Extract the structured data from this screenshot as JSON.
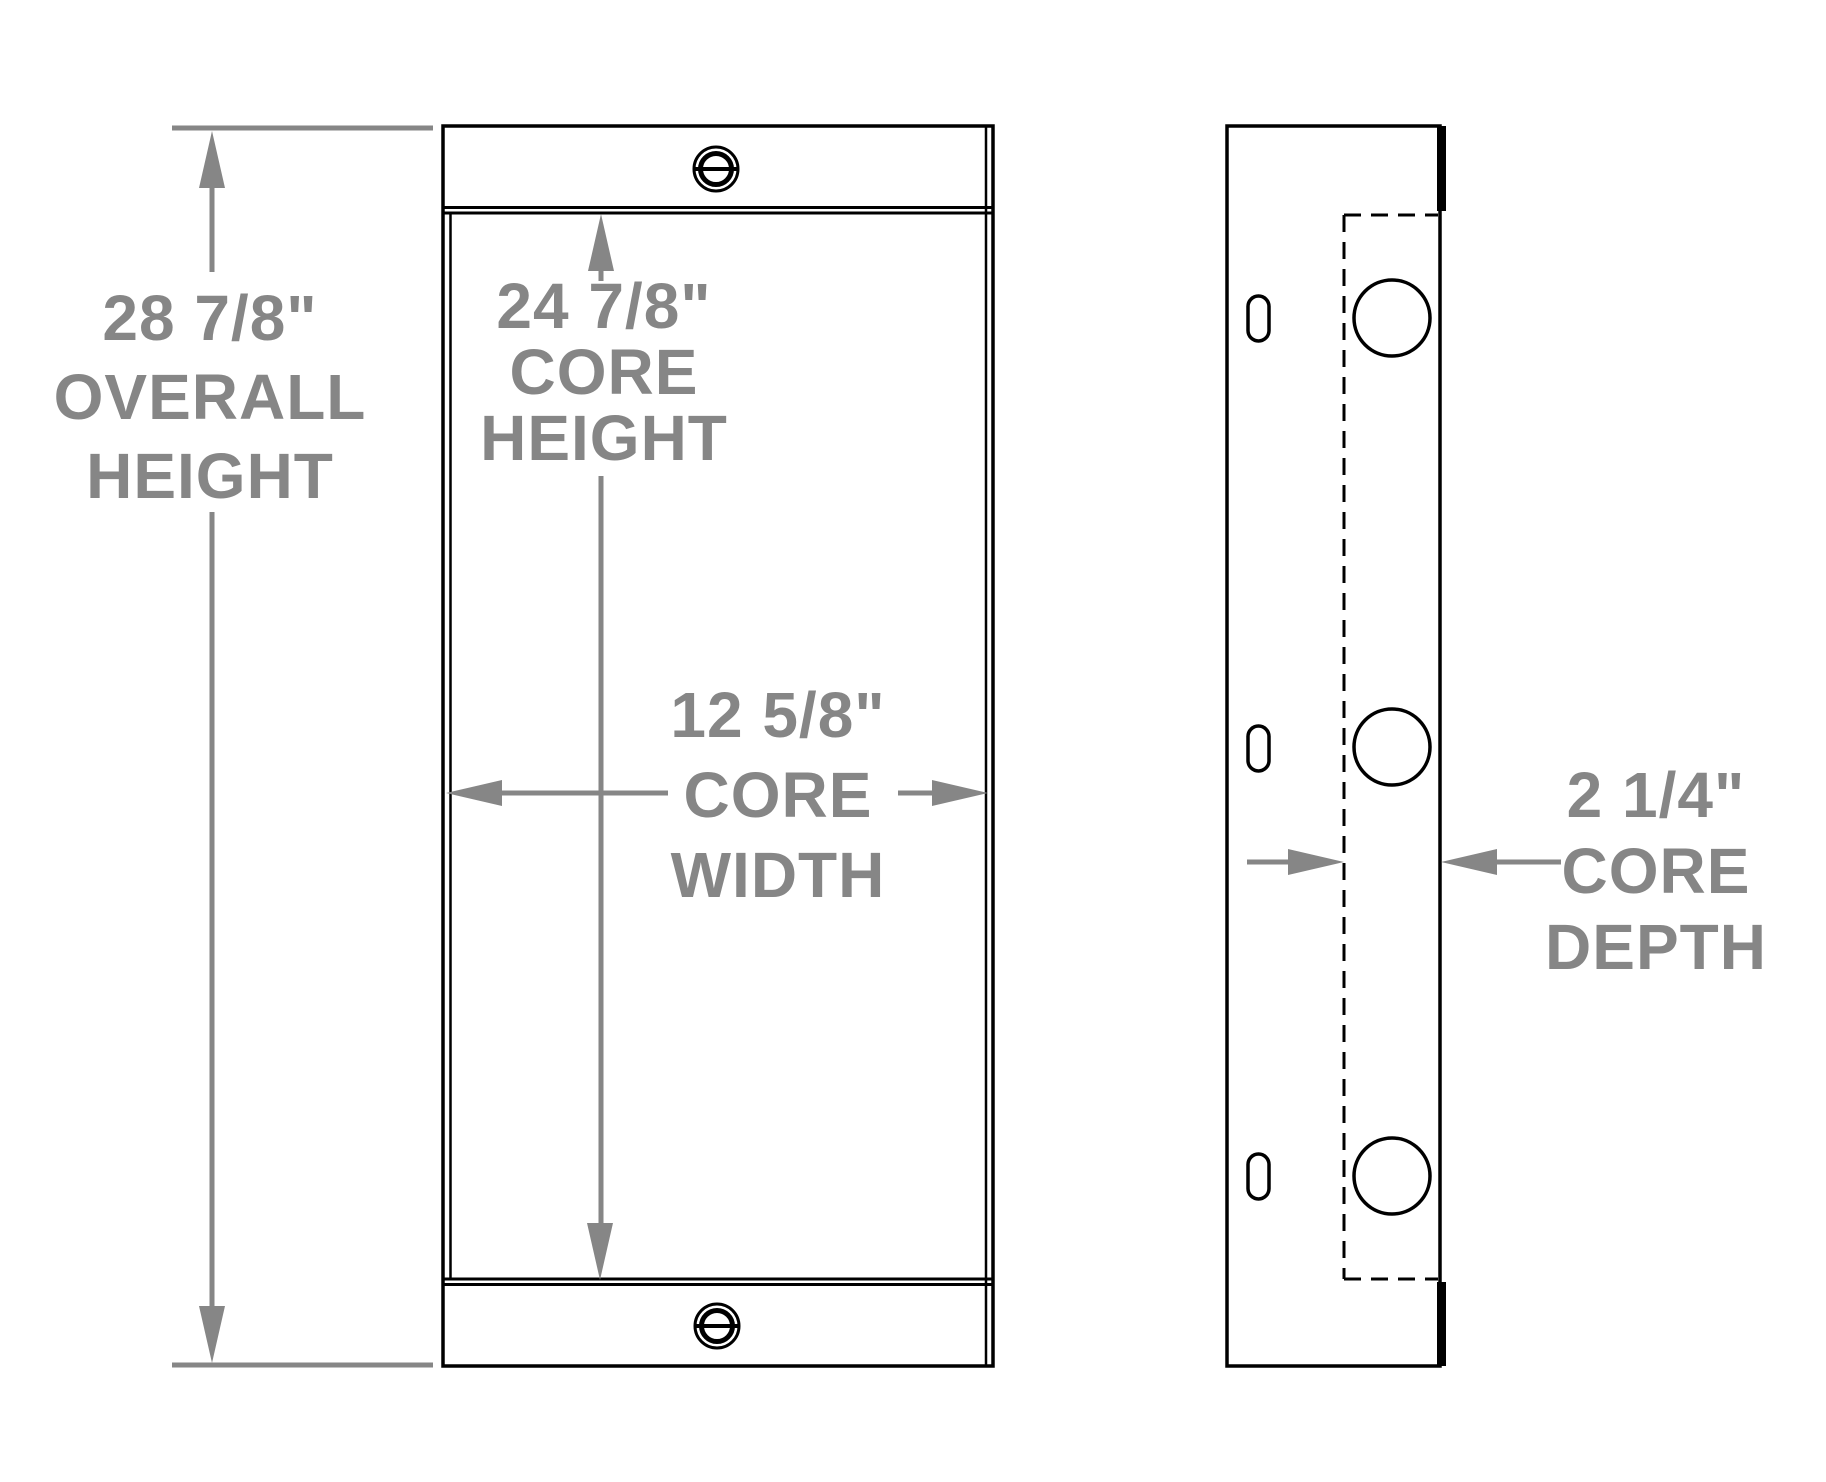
{
  "drawing": {
    "title": "heat-exchanger-dimension-drawing",
    "colors": {
      "background": "#ffffff",
      "part_outline": "#000000",
      "dimension_gray": "#868686"
    },
    "dimensions": {
      "overall_height": {
        "value": "28 7/8\"",
        "label1": "OVERALL",
        "label2": "HEIGHT"
      },
      "core_height": {
        "value": "24 7/8\"",
        "label1": "CORE",
        "label2": "HEIGHT"
      },
      "core_width": {
        "value": "12 5/8\"",
        "label1": "CORE",
        "label2": "WIDTH"
      },
      "core_depth": {
        "value": "2 1/4\"",
        "label1": "CORE",
        "label2": "DEPTH"
      }
    },
    "icons": {
      "plug": "slotted-plug-icon",
      "port": "round-port-icon",
      "slot": "mounting-slot-icon"
    }
  }
}
